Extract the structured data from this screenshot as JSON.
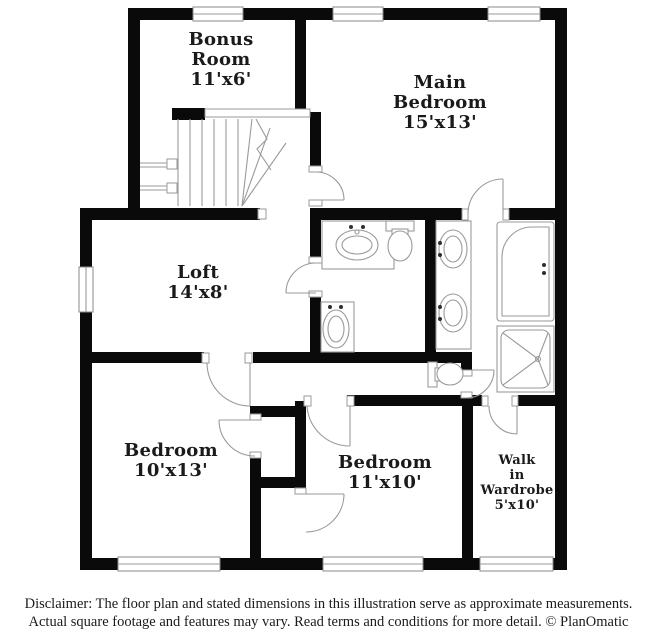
{
  "rooms": [
    {
      "lines": [
        "Bonus",
        "Room"
      ],
      "dims": "11'x6'"
    },
    {
      "lines": [
        "Main",
        "Bedroom"
      ],
      "dims": "15'x13'"
    },
    {
      "lines": [
        "Loft"
      ],
      "dims": "14'x8'"
    },
    {
      "lines": [
        "Bedroom"
      ],
      "dims": "10'x13'"
    },
    {
      "lines": [
        "Bedroom"
      ],
      "dims": "11'x10'"
    },
    {
      "lines": [
        "Walk",
        "in",
        "Wardrobe"
      ],
      "dims": "5'x10'"
    }
  ],
  "fixtures": [
    "staircase",
    "bathtub",
    "shower",
    "toilet",
    "sink",
    "double-vanity"
  ],
  "disclaimer": {
    "line1": "Disclaimer: The floor plan and stated dimensions in this illustration serve as approximate measurements.",
    "line2": "Actual square footage and features may vary. Read terms and conditions for more detail. © PlanOmatic"
  },
  "colors": {
    "wall": "#0a0a0a",
    "line": "#9a9a9a",
    "text": "#1a1a1a",
    "background": "#ffffff"
  }
}
